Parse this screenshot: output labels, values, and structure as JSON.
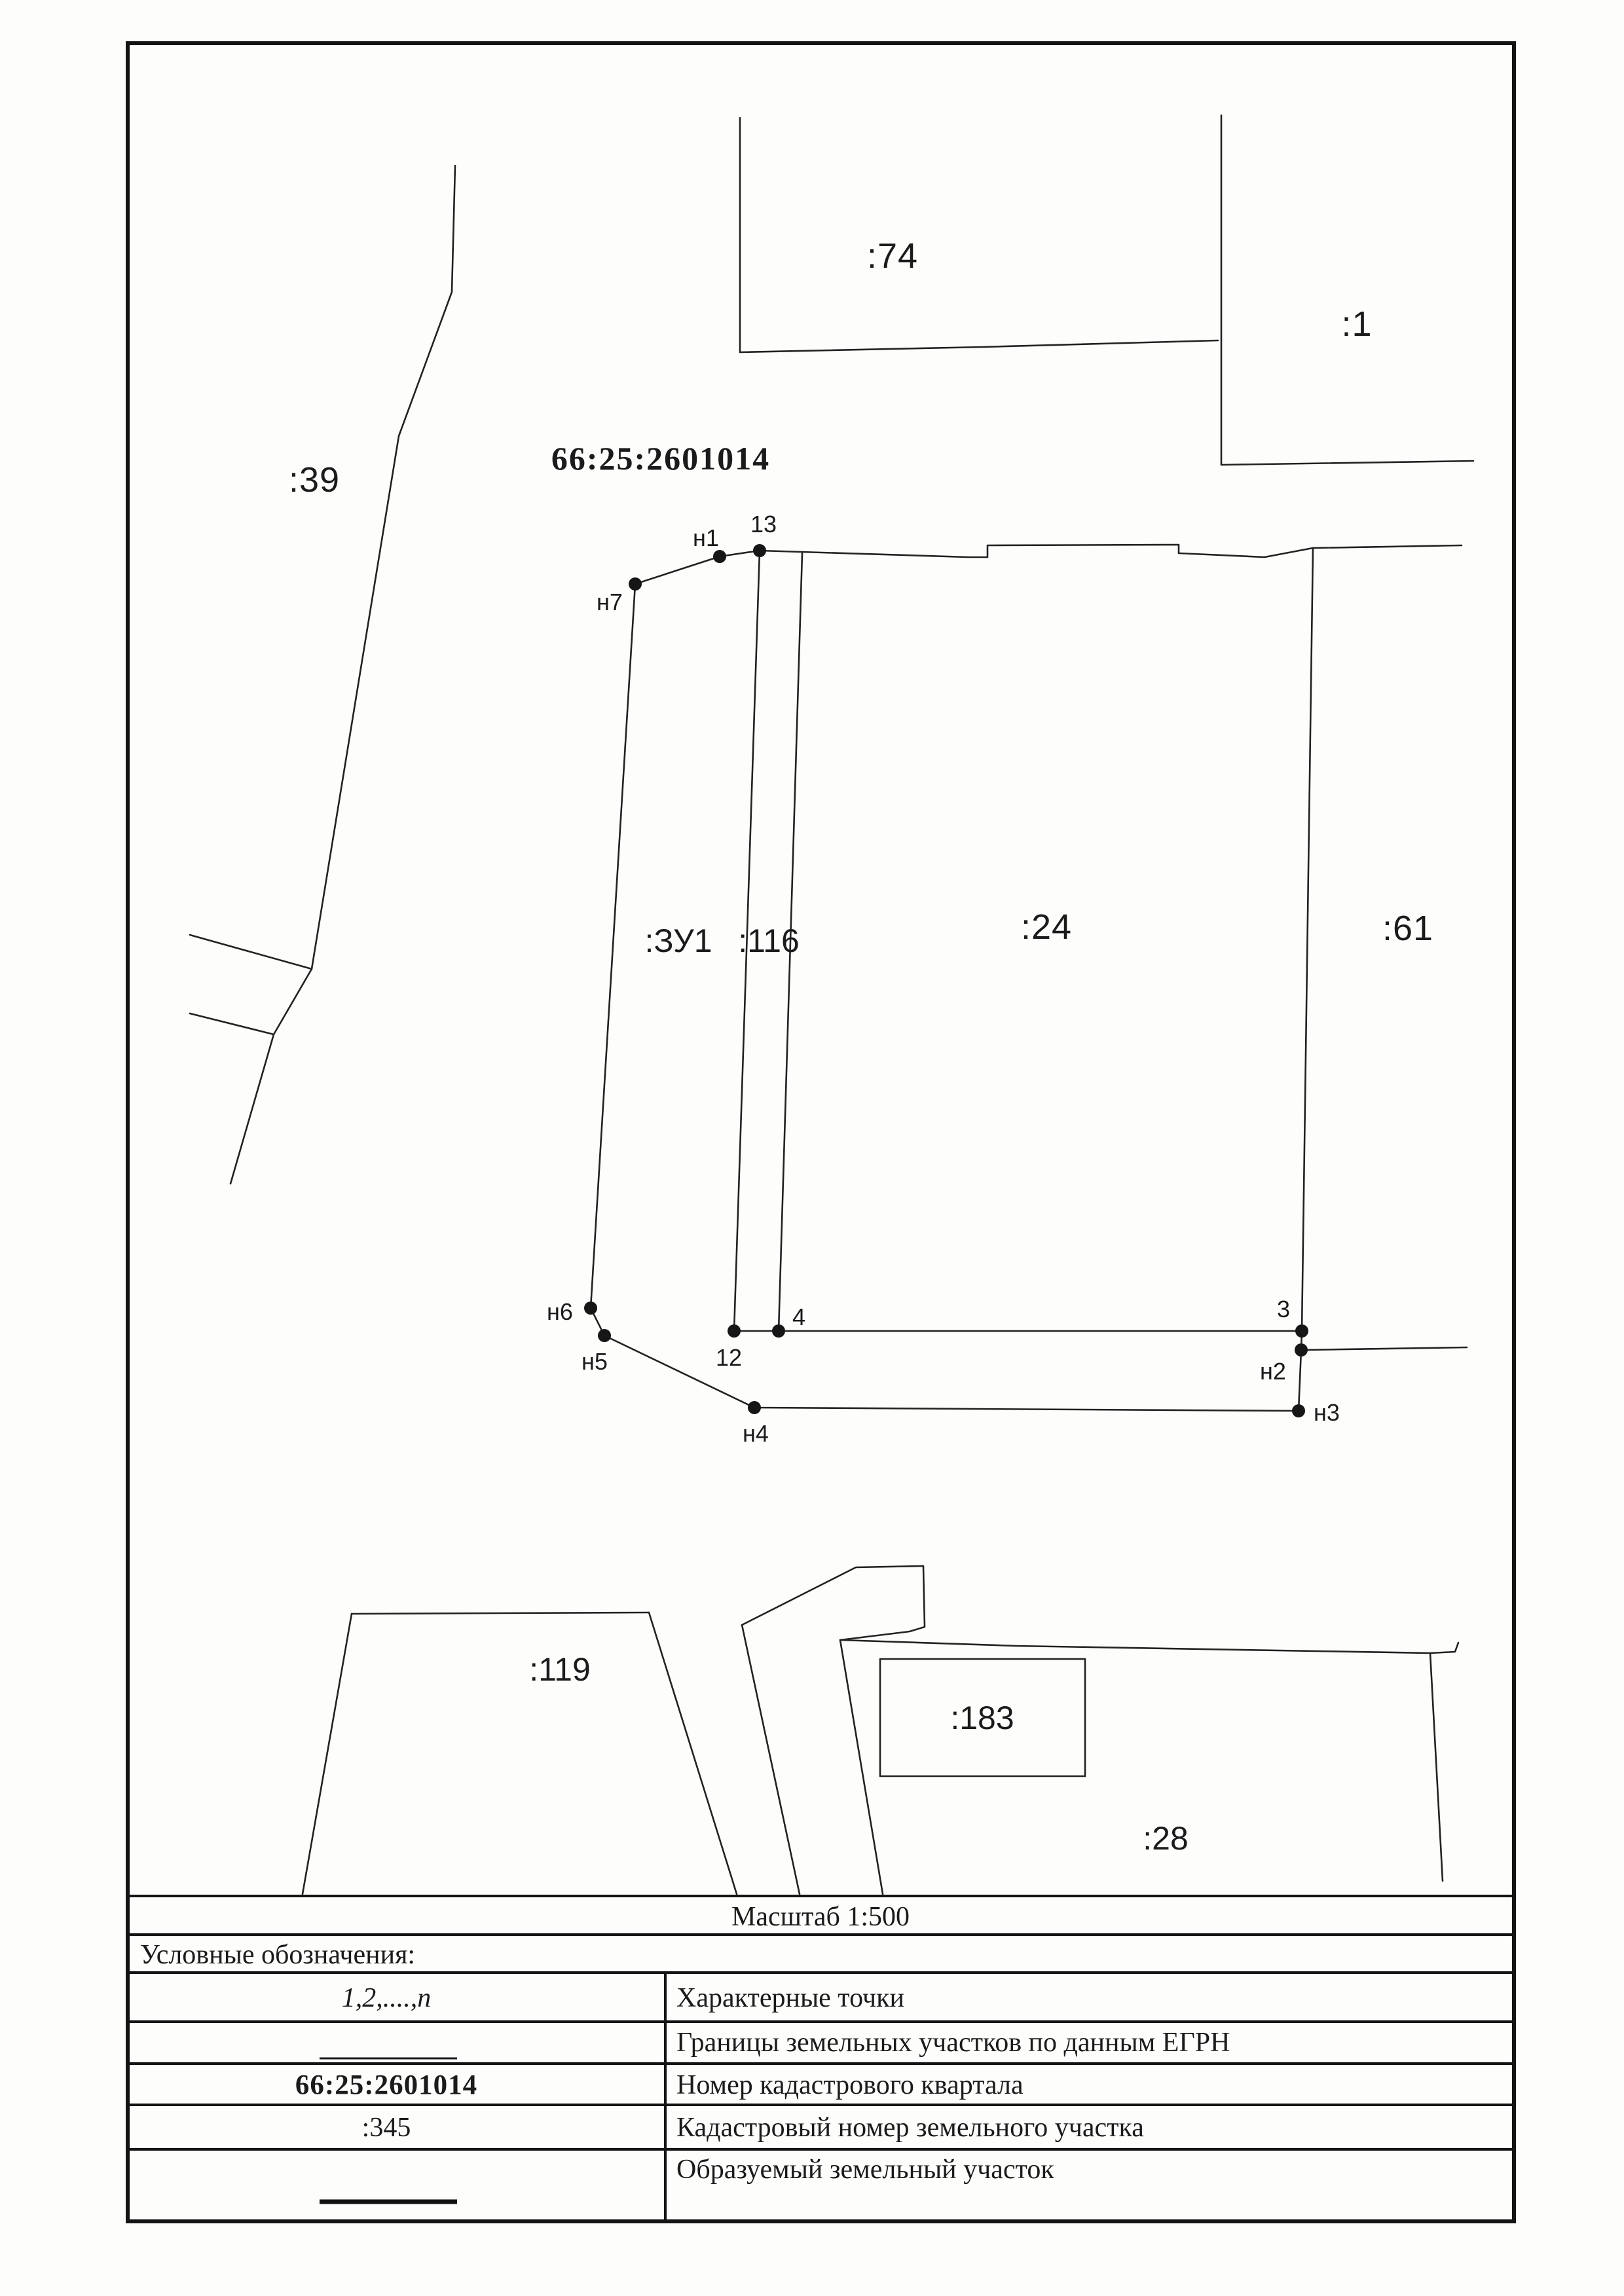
{
  "map": {
    "quarter_number": "66:25:2601014",
    "parcels": {
      "p39": ":39",
      "p74": ":74",
      "p1": ":1",
      "zu1": ":ЗУ1",
      "p116": ":116",
      "p24": ":24",
      "p61": ":61",
      "p119": ":119",
      "p183": ":183",
      "p28": ":28"
    },
    "points": {
      "h1": "н1",
      "h2": "н2",
      "h3": "н3",
      "h4": "н4",
      "h5": "н5",
      "h6": "н6",
      "h7": "н7",
      "p3": "3",
      "p4": "4",
      "p12": "12",
      "p13": "13"
    }
  },
  "scale_row": {
    "text": "Масштаб 1:500"
  },
  "legend": {
    "title": "Условные обозначения:",
    "rows": [
      {
        "symbol": "1,2,....,п",
        "description": "Характерные точки"
      },
      {
        "symbol": "",
        "description": "Границы земельных участков по данным ЕГРН"
      },
      {
        "symbol": "66:25:2601014",
        "description": "Номер кадастрового квартала"
      },
      {
        "symbol": ":345",
        "description": "Кадастровый номер земельного участка"
      },
      {
        "symbol": "",
        "description": "Образуемый земельный участок"
      }
    ]
  }
}
